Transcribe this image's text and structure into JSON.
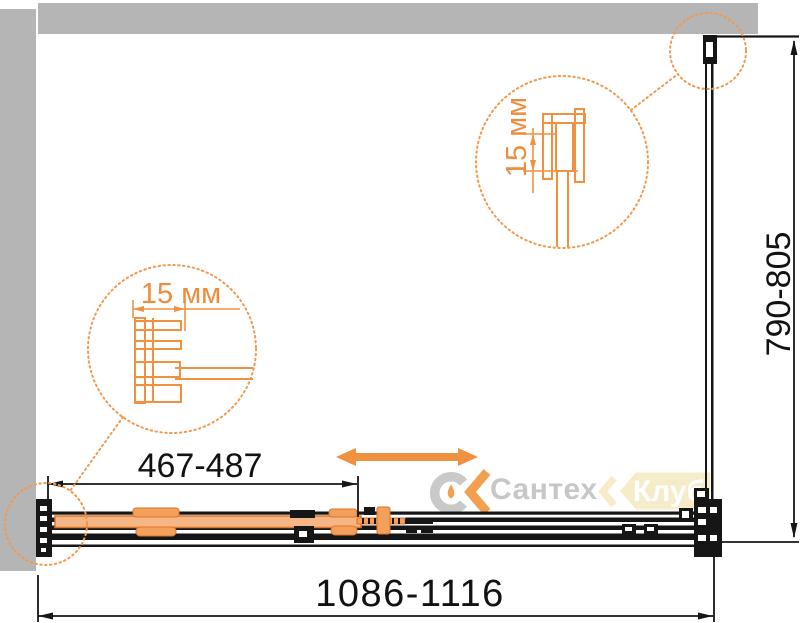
{
  "diagram": {
    "type": "shower-enclosure-dimensional-drawing",
    "dimensions": {
      "overall_width": "1086-1116",
      "overall_depth": "790-805",
      "door_opening": "467-487",
      "profile_adjustment_bottom": "15 мм",
      "profile_adjustment_side": "15 мм"
    },
    "watermark": {
      "brand": "Сантех",
      "badge": "Клуб"
    },
    "colors": {
      "accent_orange": "#ef913f",
      "line_black": "#161616",
      "wall_gray": "#b5b5b5",
      "door_fill": "#f6b584",
      "watermark_gray": "#c9c9c9",
      "watermark_cream": "#f7ecca"
    }
  }
}
